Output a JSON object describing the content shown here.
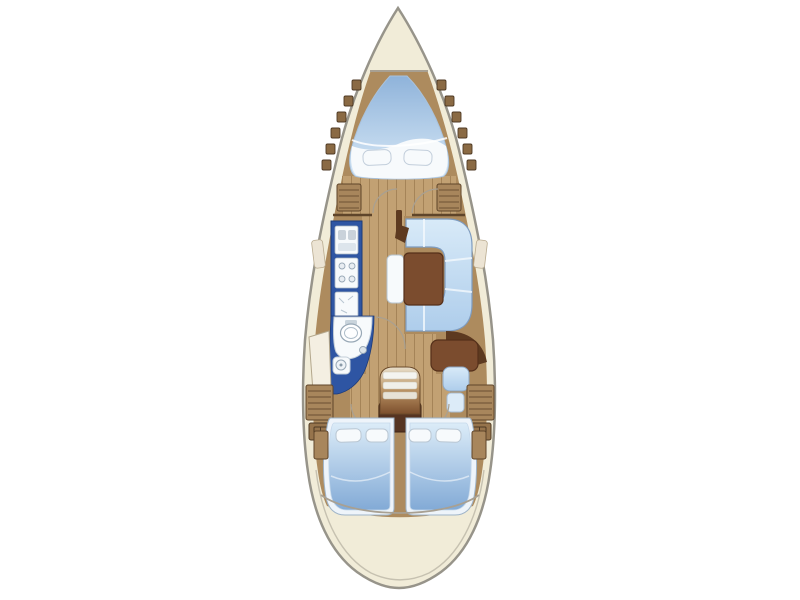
{
  "diagram": {
    "title": "Sailing yacht interior layout plan, bow at top",
    "type": "boat-floor-plan",
    "sections": [
      {
        "id": "anchor-locker",
        "label": "Anchor locker"
      },
      {
        "id": "forward-cabin",
        "label": "Forward cabin with V-berth and lockers"
      },
      {
        "id": "salon",
        "label": "Salon with U-shaped settee and table"
      },
      {
        "id": "galley",
        "label": "Galley with sink, stove and counter"
      },
      {
        "id": "head",
        "label": "Head with toilet, shower and wash basin"
      },
      {
        "id": "nav-station",
        "label": "Navigation station with chart table and seat"
      },
      {
        "id": "companionway",
        "label": "Companionway steps over engine box"
      },
      {
        "id": "aft-cabin-port",
        "label": "Port aft cabin with double berth"
      },
      {
        "id": "aft-cabin-starboard",
        "label": "Starboard aft cabin with double berth"
      },
      {
        "id": "cockpit",
        "label": "Cockpit and transom"
      }
    ]
  },
  "palette": {
    "cream": "#f1ecd8",
    "hullStroke": "#97948a",
    "innerRim": "#c6c1b0",
    "wood": "#ad8b5e",
    "floor": "#c2a173",
    "plank": "#8d6b42",
    "blue": "#2e55a3",
    "blueDark": "#1c3a78",
    "white": "#f7fafc",
    "sofaLight": "#d8eaf8",
    "sofaDark": "#aecdeb",
    "table": "#7b4c2e",
    "darkWood": "#5d3a20",
    "engine": "#563421",
    "vberthTop": "#8fb3da",
    "vberthBottom": "#d8e9f7",
    "bedHead": "#dcecf8",
    "bedFoot": "#82aad6",
    "bedFrame": "#eef4fa",
    "stepsTop": "#e9e0cd",
    "stepsMid": "#bf9868",
    "stepsBottom": "#7c4f2d",
    "hatch": "#8a6a44",
    "locker": "#a8865c",
    "lockerLine": "#5f452a",
    "arcLine": "#a8a092",
    "fixtureLine": "#98a8b6"
  }
}
